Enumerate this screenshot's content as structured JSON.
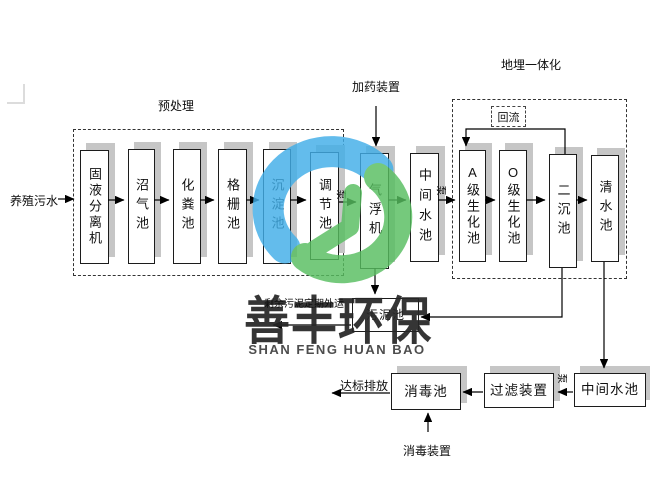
{
  "diagram": {
    "influent_label": "养殖污水",
    "groups": {
      "pretreatment": "预处理",
      "buried_integration": "地埋一体化"
    },
    "annotations": {
      "dosing_device": "加药装置",
      "reflux": "回流",
      "pump": "泵",
      "sludge_export": "剩余污泥定期外运",
      "discharge": "达标排放",
      "disinfection_device": "消毒装置"
    },
    "units": {
      "solid_liquid_separator": "固液分离机",
      "biogas_tank": "沼气池",
      "septic_tank": "化粪池",
      "grille_tank": "格栅池",
      "sedimentation_tank": "沉淀池",
      "regulating_tank": "调节池",
      "air_flotation_machine": "气浮机",
      "intermediate_tank_top": "中间水池",
      "a_grade_biochemical_tank": "A级生化池",
      "o_grade_biochemical_tank": "O级生化池",
      "secondary_sedimentation_tank": "二沉池",
      "clean_water_tank": "清水池",
      "sludge_tank": "污泥池",
      "intermediate_tank_bottom": "中间水池",
      "filter_device": "过滤装置",
      "disinfection_tank": "消毒池"
    },
    "watermark": {
      "cn": "善丰环保",
      "en": "SHAN FENG HUAN BAO"
    },
    "colors": {
      "logo_blue": "#41AEE8",
      "logo_green": "#57BE60",
      "box_shadow": "#c6c6c6"
    }
  }
}
